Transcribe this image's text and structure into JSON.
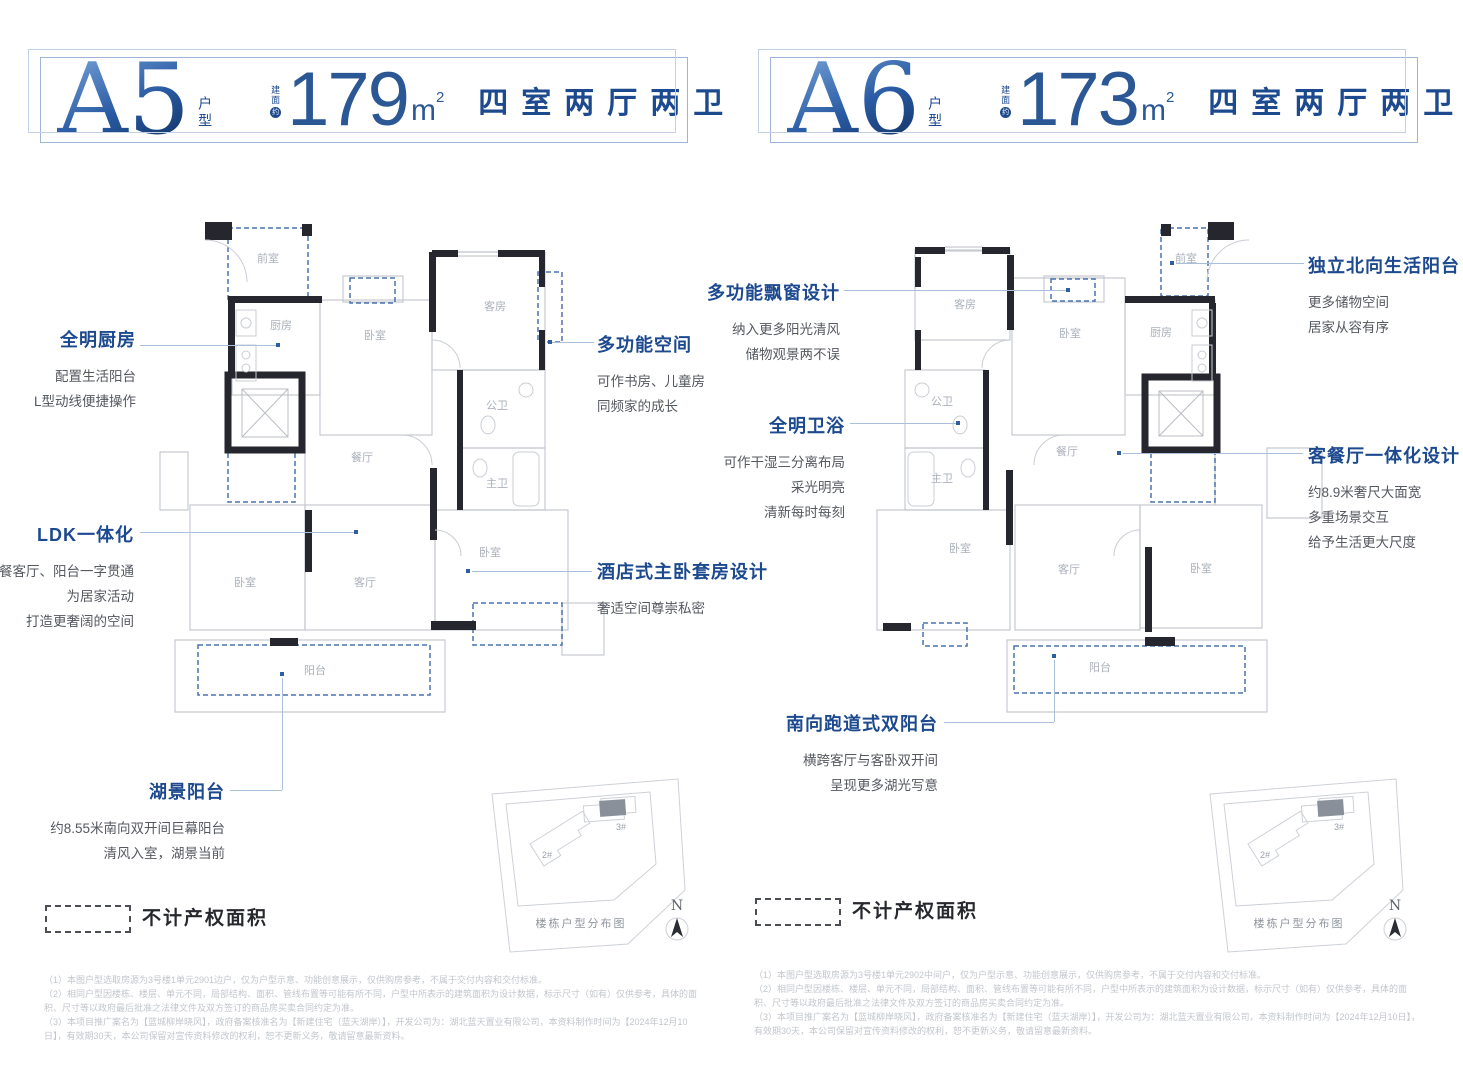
{
  "colors": {
    "accent": "#1d4a8f",
    "number_blue": "#2b5894",
    "wall": "#26262e",
    "dashed_blue": "#4a73b2",
    "desc_gray": "#54585f",
    "room_label": "#aab0ba",
    "note_gray": "#c2c6cc"
  },
  "units": [
    {
      "header": {
        "name": "A5",
        "type_label": "户型",
        "area_prefix": "建面",
        "area_circle": "约",
        "area_value": "179",
        "area_unit": "m",
        "area_sup": "2",
        "layout_label": "四室两厅两卫"
      },
      "plan": {
        "rooms": {
          "foyer": "前室",
          "kitchen": "厨房",
          "bedroom_top": "卧室",
          "guest": "客房",
          "public_bath": "公卫",
          "dining": "餐厅",
          "master_bath": "主卫",
          "bedroom_right": "卧室",
          "living": "客厅",
          "bedroom_left": "卧室",
          "balcony": "阳台"
        }
      },
      "callouts": [
        {
          "title": "全明厨房",
          "lines": [
            "配置生活阳台",
            "L型动线便捷操作"
          ]
        },
        {
          "title": "LDK一体化",
          "lines": [
            "餐客厅、阳台一字贯通",
            "为居家活动",
            "打造更奢阔的空间"
          ]
        },
        {
          "title": "湖景阳台",
          "lines": [
            "约8.55米南向双开间巨幕阳台",
            "清风入室，湖景当前"
          ]
        },
        {
          "title": "多功能空间",
          "lines": [
            "可作书房、儿童房",
            "同频家的成长"
          ]
        },
        {
          "title": "酒店式主卧套房设计",
          "lines": [
            "奢适空间尊崇私密"
          ]
        }
      ],
      "legend": "不计产权面积",
      "sitemap": {
        "caption": "楼栋户型分布图",
        "north": "N",
        "b2": "2#",
        "b3": "3#"
      },
      "notes": [
        "（1）本图户型选取房源为3号楼1单元2901边户，仅为户型示意、功能创意展示，仅供购房参考，不属于交付内容和交付标准。",
        "（2）相同户型因楼栋、楼层、单元不同，局部结构、面积、管线布置等可能有所不同，户型中所表示的建筑面积为设计数据，标示尺寸（如有）仅供参考，具体的面积、尺寸等以政府最后批准之法律文件及双方签订的商品房买卖合同约定为准。",
        "（3）本项目推广案名为【蓝城柳岸晓风】，政府备案核准名为【新建住宅（蓝天湖岸）】，开发公司为：湖北蓝天置业有限公司，本资料制作时间为【2024年12月10日】，有效期30天，本公司保留对宣传资料修改的权利，恕不更新义务，敬请留意最新资料。"
      ]
    },
    {
      "header": {
        "name": "A6",
        "type_label": "户型",
        "area_prefix": "建面",
        "area_circle": "约",
        "area_value": "173",
        "area_unit": "m",
        "area_sup": "2",
        "layout_label": "四室两厅两卫"
      },
      "plan": {
        "rooms": {
          "foyer": "前室",
          "kitchen": "厨房",
          "bedroom_top": "卧室",
          "guest": "客房",
          "public_bath": "公卫",
          "dining": "餐厅",
          "master_bath": "主卫",
          "bedroom_right": "卧室",
          "living": "客厅",
          "bedroom_left": "卧室",
          "balcony": "阳台"
        }
      },
      "callouts": [
        {
          "title": "多功能飘窗设计",
          "lines": [
            "纳入更多阳光清风",
            "储物观景两不误"
          ]
        },
        {
          "title": "全明卫浴",
          "lines": [
            "可作干湿三分离布局",
            "采光明亮",
            "清新每时每刻"
          ]
        },
        {
          "title": "南向跑道式双阳台",
          "lines": [
            "横跨客厅与客卧双开间",
            "呈现更多湖光写意"
          ]
        },
        {
          "title": "独立北向生活阳台",
          "lines": [
            "更多储物空间",
            "居家从容有序"
          ]
        },
        {
          "title": "客餐厅一体化设计",
          "lines": [
            "约8.9米奢尺大面宽",
            "多重场景交互",
            "给予生活更大尺度"
          ]
        }
      ],
      "legend": "不计产权面积",
      "sitemap": {
        "caption": "楼栋户型分布图",
        "north": "N",
        "b2": "2#",
        "b3": "3#"
      },
      "notes": [
        "（1）本图户型选取房源为3号楼1单元2902中间户，仅为户型示意、功能创意展示，仅供购房参考，不属于交付内容和交付标准。",
        "（2）相同户型因楼栋、楼层、单元不同，局部结构、面积、管线布置等可能有所不同，户型中所表示的建筑面积为设计数据，标示尺寸（如有）仅供参考，具体的面积、尺寸等以政府最后批准之法律文件及双方签订的商品房买卖合同约定为准。",
        "（3）本项目推广案名为【蓝城柳岸晓风】，政府备案核准名为【新建住宅（蓝天湖岸）】，开发公司为：湖北蓝天置业有限公司，本资料制作时间为【2024年12月10日】，有效期30天，本公司保留对宣传资料修改的权利，恕不更新义务，敬请留意最新资料。"
      ]
    }
  ]
}
